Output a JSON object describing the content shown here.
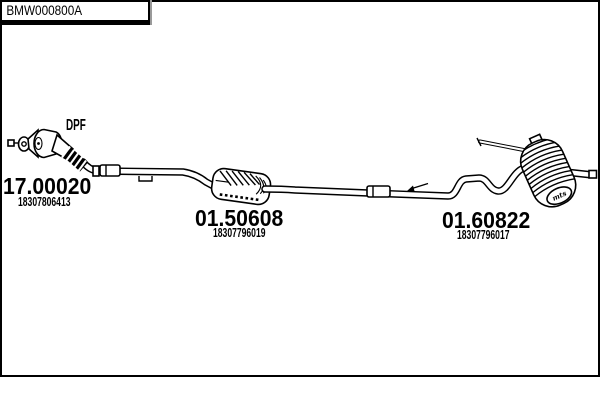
{
  "colors": {
    "ink": "#000000",
    "paper": "#ffffff"
  },
  "diagram": {
    "dpf_label": "DPF",
    "parts": [
      {
        "code": "17.00020",
        "oem": "18307806413"
      },
      {
        "code": "01.50608",
        "oem": "18307796019"
      },
      {
        "code": "01.60822",
        "oem": "18307796017"
      }
    ],
    "rear_silencer_badge": "mts"
  },
  "footer": {
    "drawing_ref": "BMW000800A"
  }
}
